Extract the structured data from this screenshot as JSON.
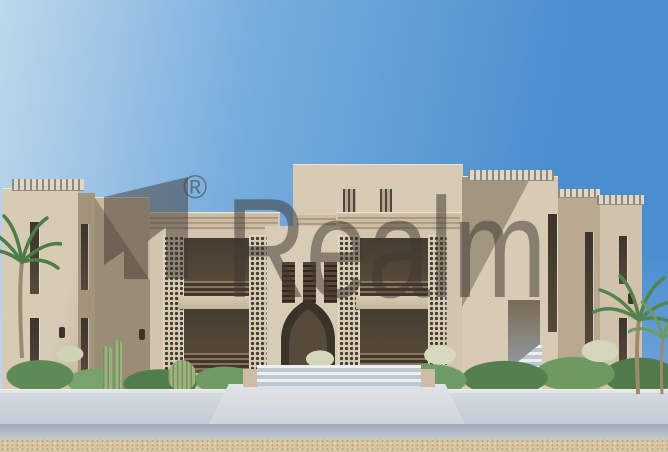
{
  "scene": {
    "type": "architectural-rendering-photo",
    "description": "Two-storey sand-coloured resort apartment building with mashrabiya lattice screens, slatted balconies, a central pointed-arch entrance, rooftop pergolas, palms, cacti and hedges in front, a pale paved walkway and a sand strip in the foreground under a clear blue sky"
  },
  "watermark": {
    "brand": "Realm",
    "registered_mark": "®"
  },
  "palette": {
    "sky_left": "#bdd8ec",
    "sky_right": "#4a8ecf",
    "wall_light": "#d8cab4",
    "wall_mid": "#d2c4ae",
    "wall_shade": "#b9a88f",
    "recess_dark": "#453d31",
    "lattice_base": "#d6c9b2",
    "lattice_dot": "#413a2f",
    "walkway_light": "#e0e3e7",
    "walkway_shade": "#ccd3db",
    "sand": "#d6c5a1",
    "foliage_dark": "#517a4b",
    "foliage_mid": "#6f9c64",
    "foliage_light": "#9db37f",
    "watermark": "rgba(63,56,49,0.52)"
  }
}
